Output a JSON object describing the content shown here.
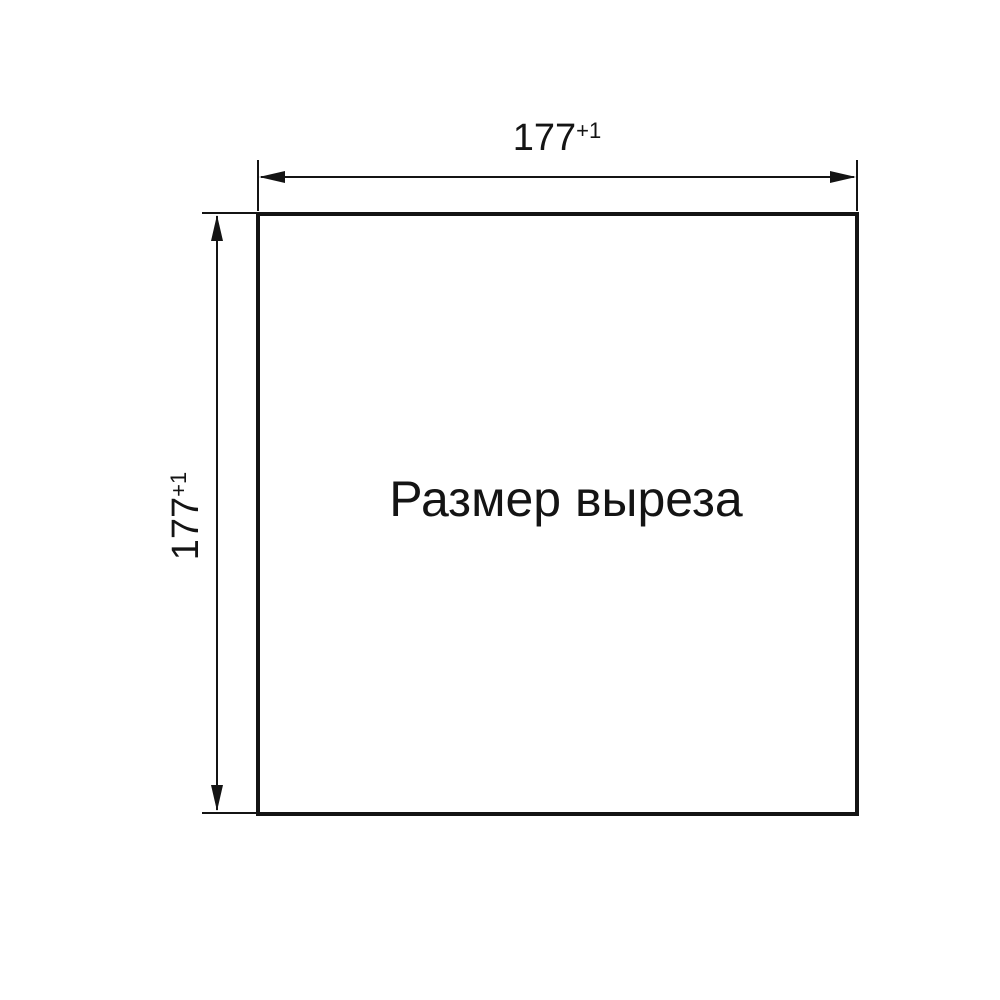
{
  "drawing": {
    "center_label": "Размер выреза",
    "top_dimension": {
      "value": "177",
      "tolerance": "+1"
    },
    "left_dimension": {
      "value": "177",
      "tolerance": "+1"
    },
    "line_color": "#141414",
    "background_color": "#ffffff"
  }
}
